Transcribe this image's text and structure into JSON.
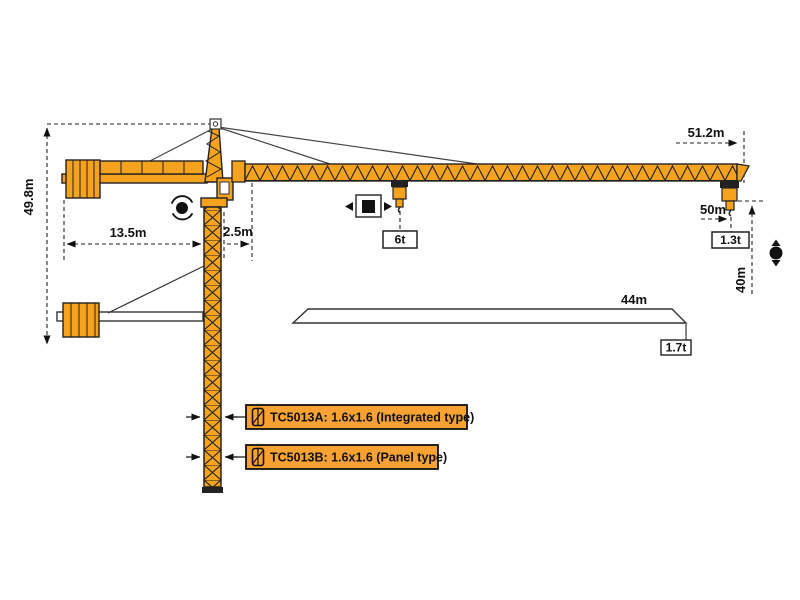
{
  "diagram_title": "TC5013 tower crane working range diagram",
  "dims": {
    "tip_radius": "51.2m",
    "height": "49.8m",
    "counter_jib": "13.5m",
    "offset": "2.5m",
    "hook_radius": "50m",
    "hook_height": "40m",
    "short_jib": "44m"
  },
  "loads": {
    "max": "6t",
    "tip_50m": "1.3t",
    "tip_44m": "1.7t"
  },
  "variants": [
    {
      "label": "TC5013A:  1.6x1.6  (Integrated type)"
    },
    {
      "label": "TC5013B:  1.6x1.6  (Panel type)"
    }
  ],
  "colors": {
    "crane_orange": "#F5A31E",
    "outline": "#1a1a1a",
    "label_bg": "#F7A233",
    "background": "#ffffff"
  }
}
